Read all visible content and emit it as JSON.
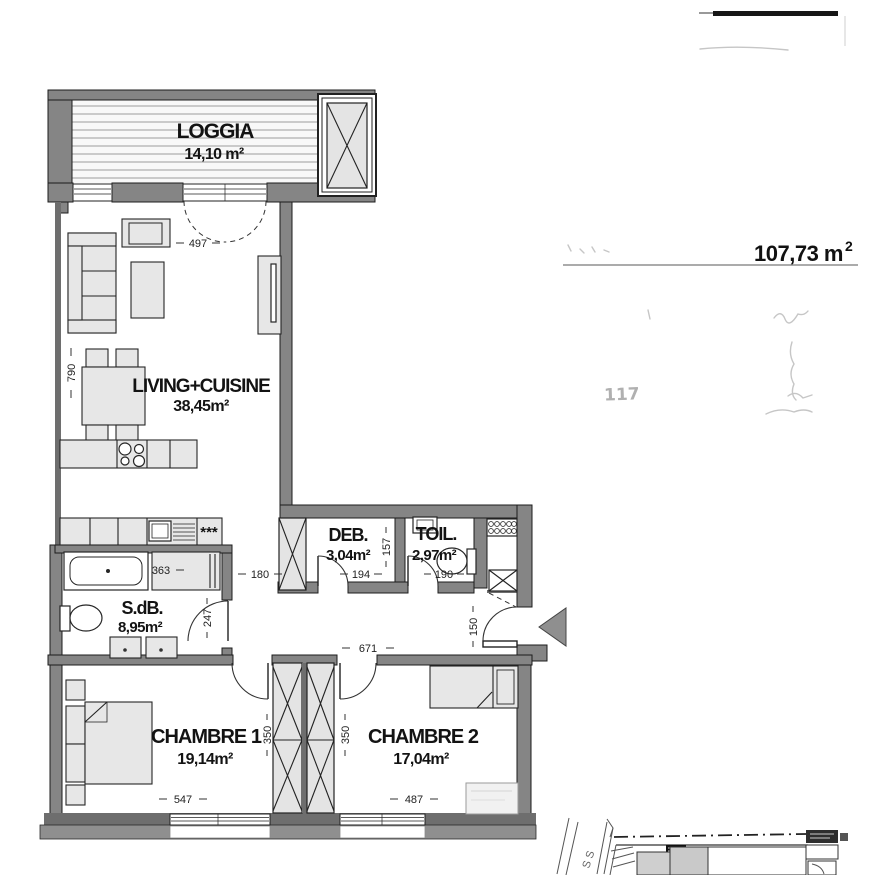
{
  "plan": {
    "rooms": {
      "loggia": {
        "name": "LOGGIA",
        "area": "14,10 m²"
      },
      "living": {
        "name": "LIVING+CUISINE",
        "area": "38,45m²"
      },
      "deb": {
        "name": "DEB.",
        "area": "3,04m²"
      },
      "toil": {
        "name": "TOIL.",
        "area": "2,97m²"
      },
      "sdb": {
        "name": "S.dB.",
        "area": "8,95m²"
      },
      "chambre1": {
        "name": "CHAMBRE 1",
        "area": "19,14m²"
      },
      "chambre2": {
        "name": "CHAMBRE 2",
        "area": "17,04m²"
      }
    },
    "dimensions": {
      "loggia_door_width": "497",
      "living_depth": "790",
      "passage_width": "180",
      "bath_counter_width": "363",
      "bath_door_width": "247",
      "deb_depth": "157",
      "deb_width": "194",
      "toil_width": "190",
      "entry_door_width": "150",
      "hall_length": "671",
      "chambre1_door": "350",
      "chambre2_door": "350",
      "chambre1_width": "547",
      "chambre2_width": "487"
    },
    "symbols": {
      "freezer_stars": "***"
    }
  },
  "annotations": {
    "total_area_value": "107,73 m",
    "total_area_exponent": "2",
    "handwritten_note": "117"
  },
  "site_plan": {
    "street_label": "S S"
  },
  "colors": {
    "wall_gray": "#858585",
    "furniture_fill": "#e7e7e7",
    "outline": "#1c1c1c",
    "entry_arrow": "#8f8f8f",
    "paper": "#ffffff"
  }
}
